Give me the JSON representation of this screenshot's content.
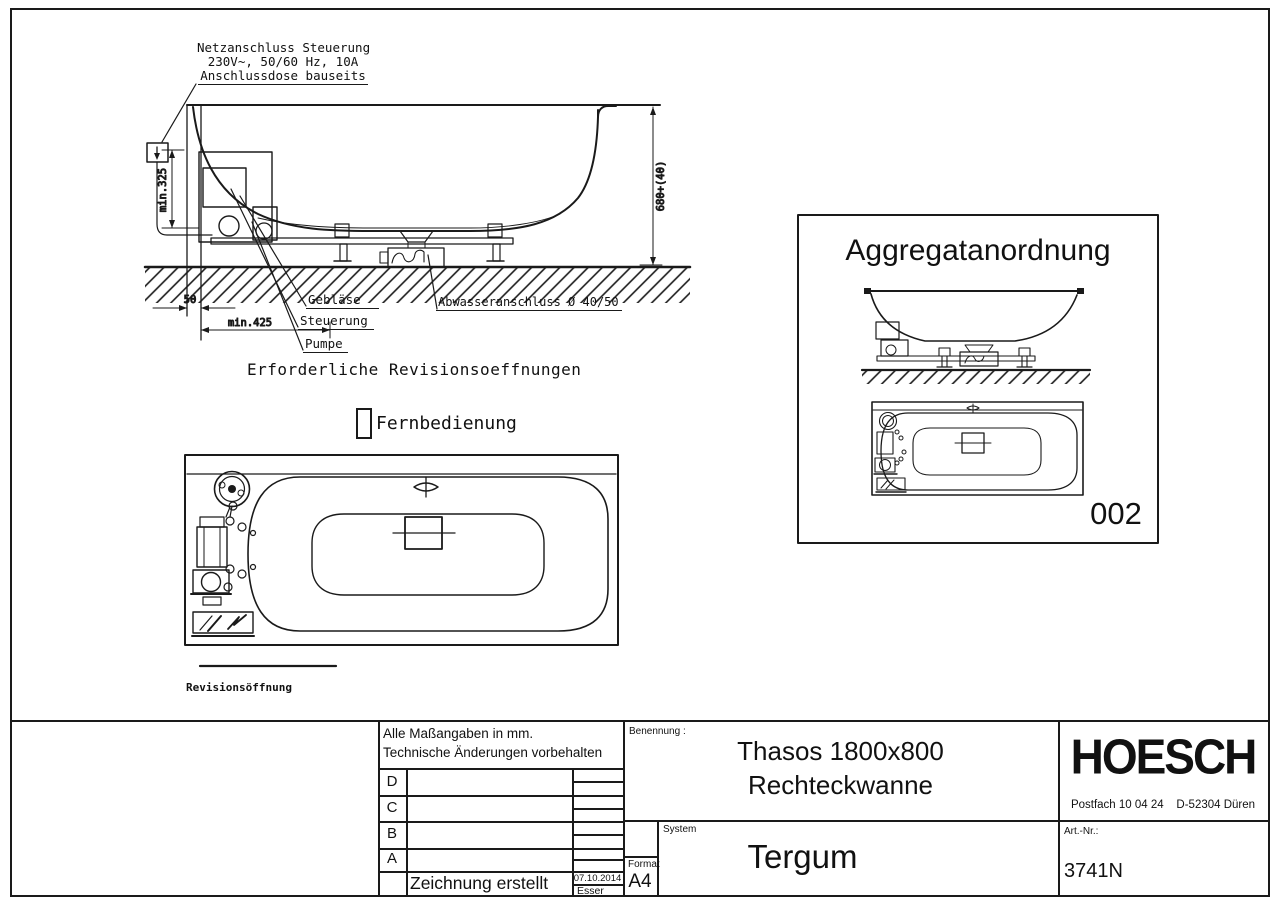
{
  "sheet": {
    "side_view": {
      "power_note_line1": "Netzanschluss Steuerung",
      "power_note_line2": "230V~, 50/60 Hz, 10A",
      "power_note_line3": "Anschlussdose bauseits",
      "dim_min_325": "min.325",
      "dim_50": "50",
      "dim_min_425": "min.425",
      "dim_height": "680+(40)",
      "label_blower": "Gebläse",
      "label_control": "Steuerung",
      "label_pump": "Pumpe",
      "label_drain": "Abwasseranschluss Ø 40/50",
      "note_required_openings": "Erforderliche Revisionsoeffnungen",
      "label_remote": "Fernbedienung"
    },
    "plan_view": {
      "label_opening": "Revisionsöffnung"
    },
    "aggregate_box": {
      "title": "Aggregatanordnung",
      "number": "002"
    }
  },
  "title_block": {
    "note_line1": "Alle Maßangaben in mm.",
    "note_line2": "Technische Änderungen vorbehalten",
    "revision_rows": [
      "D",
      "C",
      "B",
      "A"
    ],
    "created_label": "Zeichnung erstellt",
    "created_date": "07.10.2014",
    "created_by": "Esser",
    "name_label": "Benennung :",
    "name_line1": "Thasos 1800x800",
    "name_line2": "Rechteckwanne",
    "system_label": "System",
    "system_value": "Tergum",
    "format_label": "Format",
    "format_value": "A4",
    "art_label": "Art.-Nr.:",
    "art_value": "3741N",
    "logo": "HOESCH",
    "address": "Postfach 10 04 24    D-52304 Düren"
  },
  "colors": {
    "line": "#1a1a1a",
    "text": "#111111",
    "background": "#ffffff"
  }
}
